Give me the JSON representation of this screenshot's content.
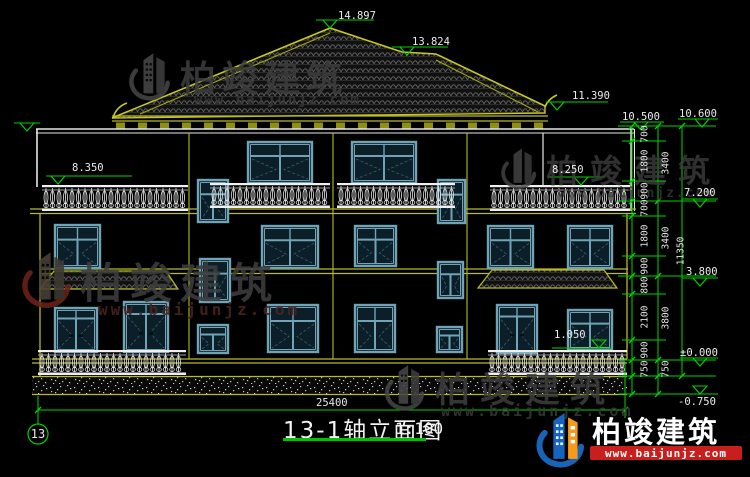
{
  "drawing": {
    "title": "13-1轴立面图",
    "scale": "1:100",
    "axis_bubble": "13",
    "bottom_dimension": "25400",
    "elevations": {
      "ridge": "14.897",
      "shoulder": "13.824",
      "eave_right": "11.390",
      "parapet_left": "10.500",
      "parapet_right": "10.600",
      "terrace_left": "8.350",
      "terrace_right": "8.250",
      "floor3": "7.200",
      "floor2": "3.800",
      "window_sill": "1.050",
      "ground": "±0.000",
      "site": "-0.750"
    },
    "dim_chain_inner": [
      "700",
      "1800",
      "900",
      "700",
      "1800",
      "900",
      "800",
      "2100",
      "900",
      "750"
    ],
    "dim_chain_mid": [
      "3400",
      "3400",
      "3800",
      "750"
    ],
    "dim_chain_outer": [
      "11350"
    ]
  },
  "watermark": {
    "name": "柏竣建筑",
    "url": "www.baijunjz.com"
  },
  "colors": {
    "dimension_green": "#00d400",
    "wall_yellow": "#b9b92a",
    "window_frame": "#6fa3b6",
    "logo_blue": "#1565c0",
    "logo_orange": "#f59a1a",
    "logo_red": "#c81e1e"
  }
}
